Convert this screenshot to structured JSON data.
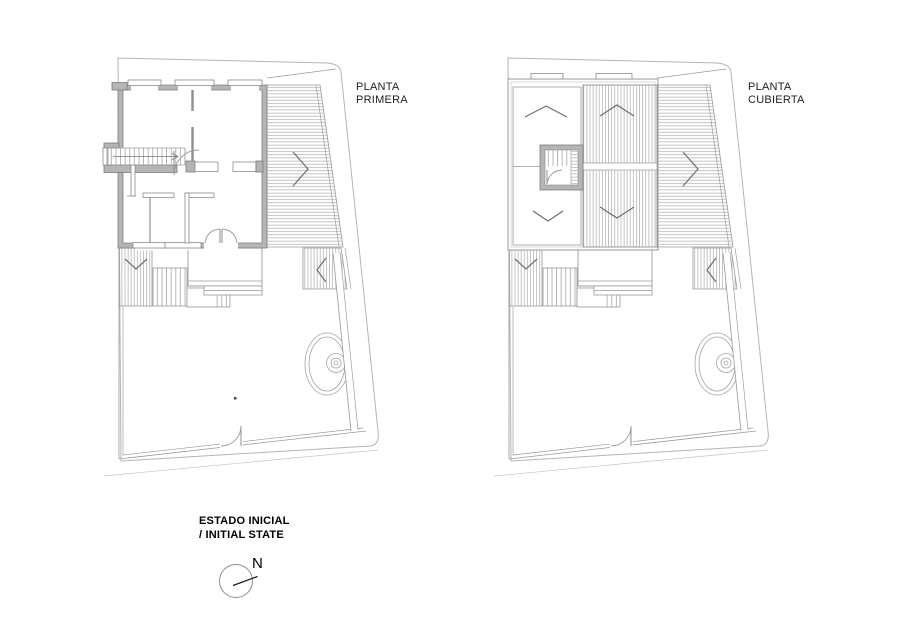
{
  "plans": {
    "left": {
      "title_line1": "PLANTA",
      "title_line2": "PRIMERA"
    },
    "right": {
      "title_line1": "PLANTA",
      "title_line2": "CUBIERTA"
    }
  },
  "caption": {
    "line1": "ESTADO INICIAL",
    "line2": "/ INITIAL STATE"
  },
  "compass": {
    "north_label": "N"
  },
  "colors": {
    "background": "#ffffff",
    "wall_fill": "#b5b5b5",
    "wall_stroke": "#7d7d7d"
  }
}
